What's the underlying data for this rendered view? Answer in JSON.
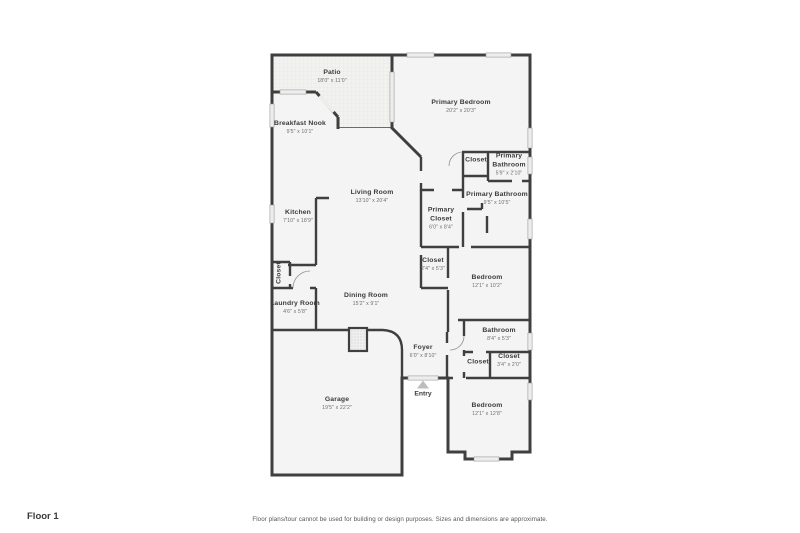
{
  "colors": {
    "wall": "#3f3f3f",
    "room_fill": "#f4f4f4",
    "window_fill": "#ededed",
    "window_edge": "#9c9c9c",
    "patio_fill": "#f2f2f0",
    "patio_grid": "#e3e3e0",
    "label": "#3b3b3b",
    "dims": "#6e6e6e",
    "footer_text": "#3a3a3a",
    "disclaimer_text": "#555555",
    "entry_arrow": "#bdbdbd"
  },
  "footer": {
    "floor_label": "Floor 1",
    "disclaimer": "Floor plans/tour cannot be used for building or design purposes. Sizes and dimensions are approximate."
  },
  "entry": {
    "label": "Entry"
  },
  "rooms": [
    {
      "name": "Patio",
      "dims": "18'0\" x 11'0\"",
      "x": 332,
      "y": 77
    },
    {
      "name": "Primary Bedroom",
      "dims": "20'2\" x 20'3\"",
      "x": 461,
      "y": 107
    },
    {
      "name": "Breakfast Nook",
      "dims": "9'5\" x 10'1\"",
      "x": 300,
      "y": 128
    },
    {
      "name": "Closet",
      "dims": "",
      "x": 476,
      "y": 161
    },
    {
      "name": "Primary Bathroom",
      "dims": "5'9\" x 2'10\"",
      "x": 509,
      "y": 165,
      "w": 40
    },
    {
      "name": "Living Room",
      "dims": "13'10\" x 20'4\"",
      "x": 372,
      "y": 197
    },
    {
      "name": "Primary Bathroom",
      "dims": "9'5\" x 10'5\"",
      "x": 497,
      "y": 199
    },
    {
      "name": "Kitchen",
      "dims": "7'10\" x 18'9\"",
      "x": 298,
      "y": 217
    },
    {
      "name": "Primary Closet",
      "dims": "6'0\" x 8'4\"",
      "x": 441,
      "y": 219,
      "w": 34
    },
    {
      "name": "Closet",
      "dims": "2'4\" x 5'3\"",
      "x": 433,
      "y": 265
    },
    {
      "name": "Closet",
      "dims": "",
      "x": 280,
      "y": 273,
      "rotate": true
    },
    {
      "name": "Bedroom",
      "dims": "12'1\" x 10'2\"",
      "x": 487,
      "y": 282
    },
    {
      "name": "Dining Room",
      "dims": "15'2\" x 9'1\"",
      "x": 366,
      "y": 300
    },
    {
      "name": "Laundry Room",
      "dims": "4'6\" x 5'8\"",
      "x": 295,
      "y": 308
    },
    {
      "name": "Bathroom",
      "dims": "8'4\" x 5'3\"",
      "x": 499,
      "y": 335
    },
    {
      "name": "Foyer",
      "dims": "6'0\" x 8'10\"",
      "x": 423,
      "y": 352
    },
    {
      "name": "Closet",
      "dims": "",
      "x": 478,
      "y": 363
    },
    {
      "name": "Closet",
      "dims": "3'4\" x 2'0\"",
      "x": 509,
      "y": 361
    },
    {
      "name": "Garage",
      "dims": "19'5\" x 22'2\"",
      "x": 337,
      "y": 404
    },
    {
      "name": "Bedroom",
      "dims": "12'1\" x 12'8\"",
      "x": 487,
      "y": 410
    }
  ]
}
